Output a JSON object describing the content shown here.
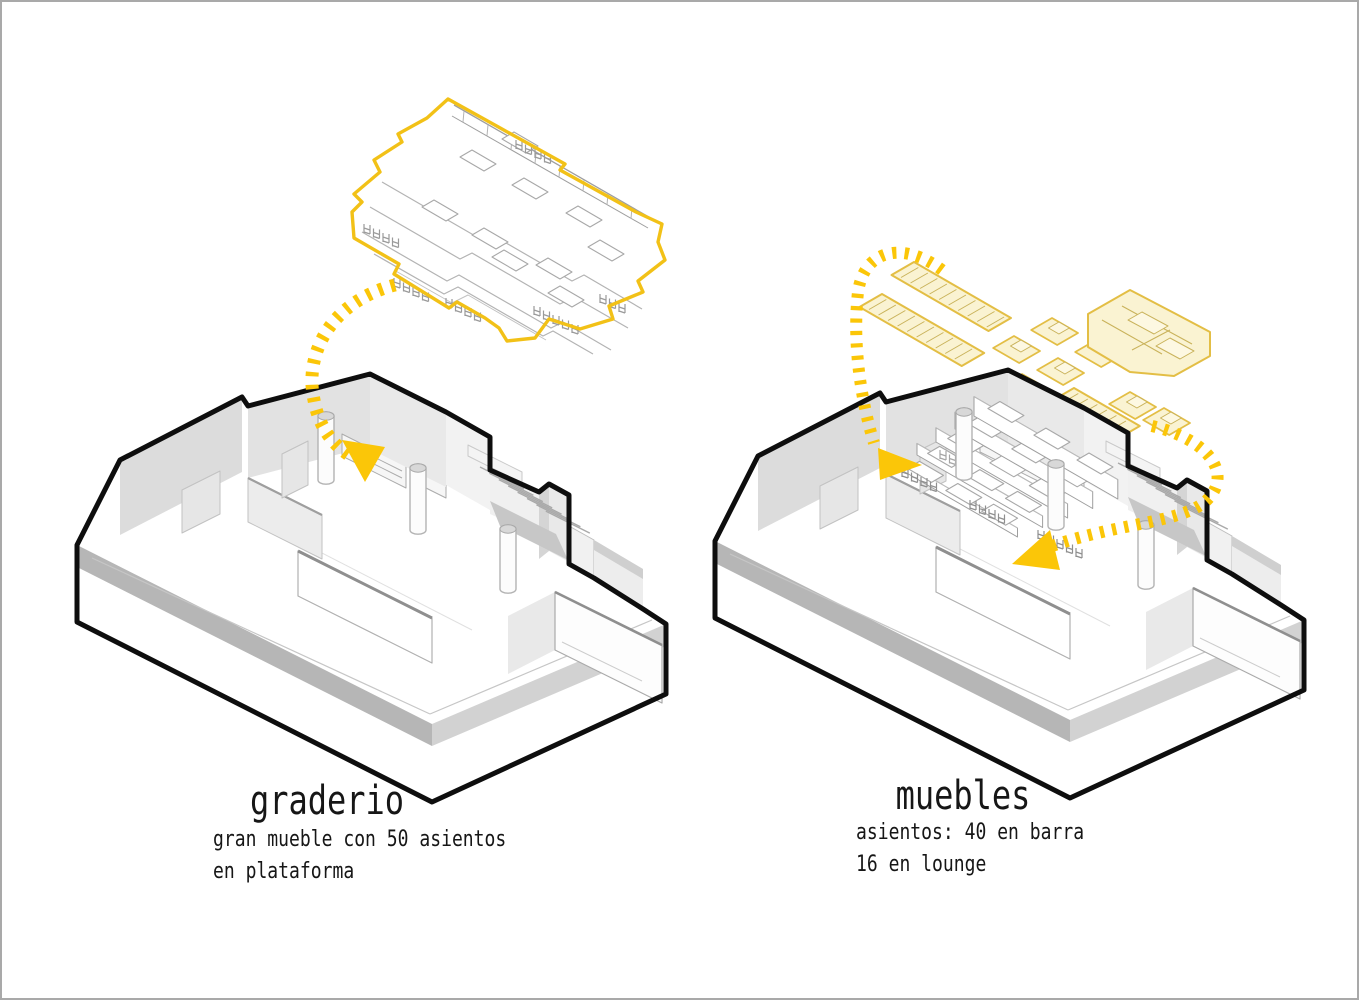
{
  "frame": {
    "background": "#ffffff",
    "border_color": "#a9a9a9"
  },
  "colors": {
    "arrow_yellow": "#fbc608",
    "furniture_outline_yellow": "#f2c117",
    "pale_yellow_fill": "#faf3d2",
    "pale_yellow_stroke": "#e3be45",
    "pale_yellow_detail": "#c9b25a",
    "silhouette_black": "#0e0e0e",
    "detail_gray": "#9e9e9e",
    "light_line_gray": "#c6c6c6",
    "wall_gray": "#e9e9e9",
    "wall_gray_dark": "#dcdcdc",
    "wall_gray_light": "#f2f2f2",
    "band_dark": "#b6b6b6",
    "band_mid": "#d2d2d2",
    "chair_gray": "#8f8f8f",
    "white": "#ffffff",
    "text_ink": "#161616"
  },
  "left_diagram": {
    "title": "graderio",
    "caption_lines": [
      "gran mueble con 50 asientos",
      "en plataforma"
    ]
  },
  "right_diagram": {
    "title": "muebles",
    "caption_lines": [
      "asientos: 40 en barra",
      "16 en lounge"
    ]
  }
}
